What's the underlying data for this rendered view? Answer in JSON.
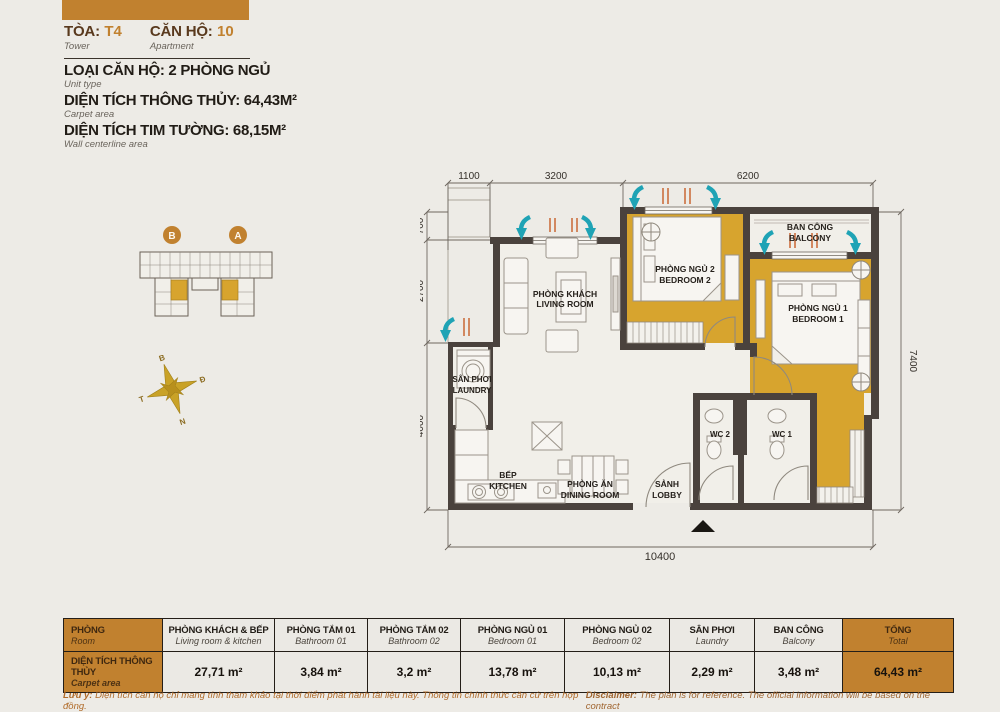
{
  "header": {
    "toa_label": "TÒA:",
    "toa_value": "T4",
    "toa_sub": "Tower",
    "can_label": "CĂN HỘ:",
    "can_value": "10",
    "can_sub": "Apartment",
    "line1": "LOẠI CĂN HỘ: 2 PHÒNG NGỦ",
    "line1_sub": "Unit type",
    "line2": "DIỆN TÍCH THÔNG THỦY: 64,43M²",
    "line2_sub": "Carpet area",
    "line3": "DIỆN TÍCH TIM TƯỜNG: 68,15M²",
    "line3_sub": "Wall centerline area"
  },
  "keyplan": {
    "wing_b": "B",
    "wing_a": "A"
  },
  "compass": {
    "n": "B",
    "e": "Đ",
    "s": "N",
    "w": "T"
  },
  "plan": {
    "dims": {
      "top1": "1100",
      "top2": "3200",
      "top3": "6200",
      "left1": "700",
      "left2": "2700",
      "left3": "4000",
      "right": "7400",
      "bottom": "10400"
    },
    "rooms": {
      "living1": "PHÒNG KHÁCH",
      "living2": "LIVING ROOM",
      "bed2a": "PHÒNG NGỦ 2",
      "bed2b": "BEDROOM 2",
      "bed1a": "PHÒNG NGỦ 1",
      "bed1b": "BEDROOM 1",
      "balcony1": "BAN CÔNG",
      "balcony2": "BALCONY",
      "laundry1": "SÂN PHƠI",
      "laundry2": "LAUNDRY",
      "kitchen1": "BẾP",
      "kitchen2": "KITCHEN",
      "dining1": "PHÒNG ĂN",
      "dining2": "DINING ROOM",
      "lobby1": "SẢNH",
      "lobby2": "LOBBY",
      "wc2": "WC 2",
      "wc1": "WC 1"
    }
  },
  "table": {
    "col0": {
      "vi": "PHÒNG",
      "en": "Room"
    },
    "row_label": {
      "vi": "DIỆN TÍCH THÔNG THỦY",
      "en": "Carpet area"
    },
    "columns": [
      {
        "vi": "PHÒNG KHÁCH & BẾP",
        "en": "Living room & kitchen",
        "value": "27,71 m²"
      },
      {
        "vi": "PHÒNG TẮM 01",
        "en": "Bathroom 01",
        "value": "3,84 m²"
      },
      {
        "vi": "PHÒNG TẮM 02",
        "en": "Bathroom 02",
        "value": "3,2 m²"
      },
      {
        "vi": "PHÒNG NGỦ 01",
        "en": "Bedroom 01",
        "value": "13,78 m²"
      },
      {
        "vi": "PHÒNG NGỦ 02",
        "en": "Bedroom 02",
        "value": "10,13 m²"
      },
      {
        "vi": "SÂN PHƠI",
        "en": "Laundry",
        "value": "2,29 m²"
      },
      {
        "vi": "BAN CÔNG",
        "en": "Balcony",
        "value": "3,48 m²"
      },
      {
        "vi": "TỔNG",
        "en": "Total",
        "value": "64,43 m²"
      }
    ]
  },
  "notes": {
    "vi_prefix": "Lưu ý:",
    "vi_text": " Diện tích căn hộ chỉ mang tính tham khảo tại thời điểm phát hành tài liệu này. Thông tin chính thức căn cứ trên hợp đồng.",
    "en_prefix": "Disclaimer:",
    "en_text": " The plan is for reference. The official information will be based on the contract"
  },
  "colors": {
    "accent_orange": "#c1812f",
    "room_gold": "#d7a42e",
    "wall": "#4a423d",
    "vent_teal": "#1fa3b5"
  }
}
